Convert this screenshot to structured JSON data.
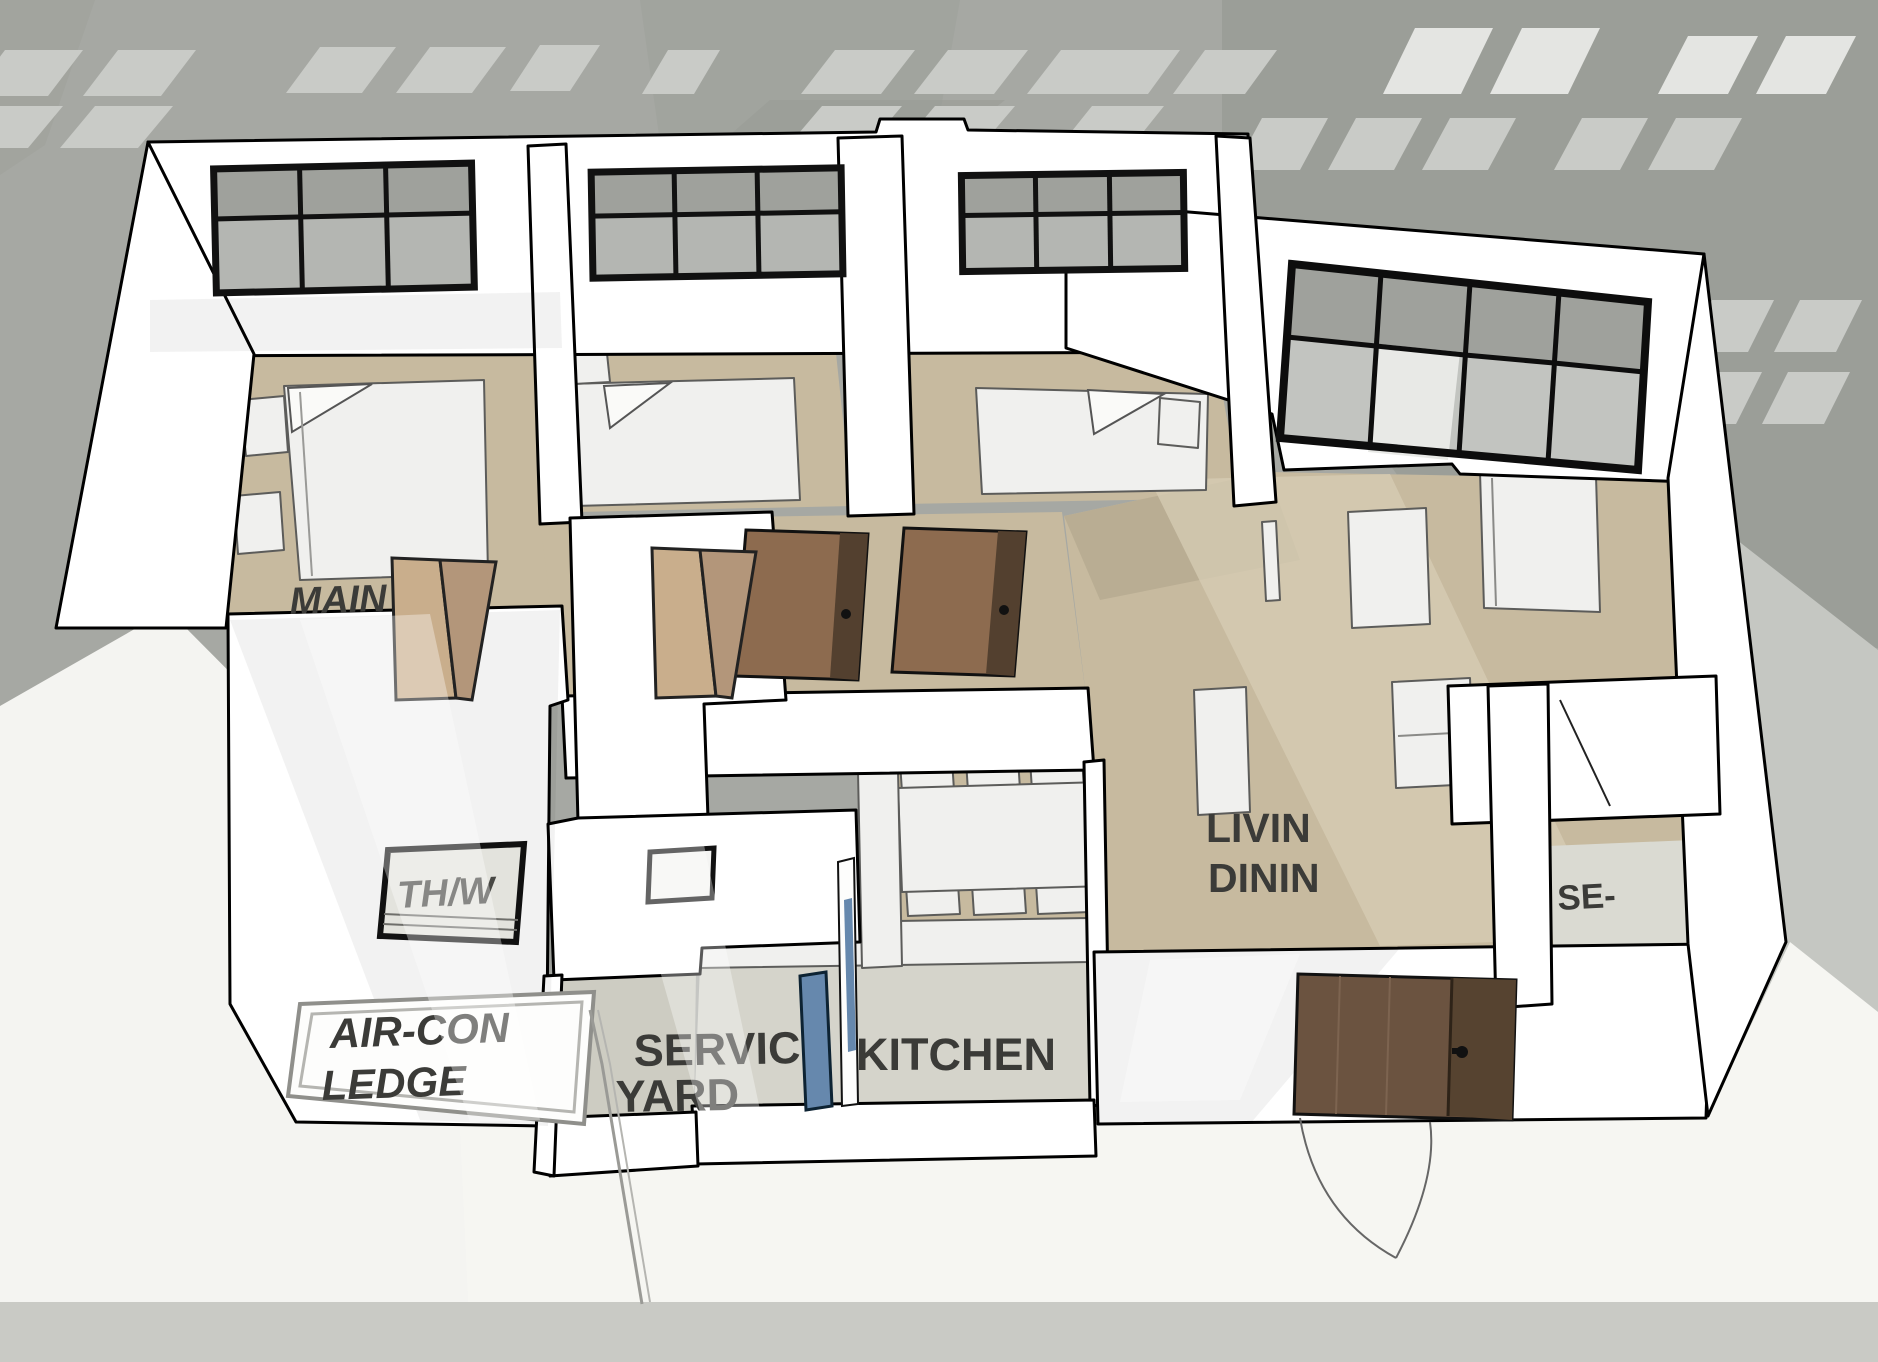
{
  "meta": {
    "scene_type": "3D floor plan cutaway render, SketchUp style",
    "view": "axonometric view of an apartment unit seen from above the front"
  },
  "colors": {
    "background_gray": "#a6a8a3",
    "building_silhouette": "#9b9e98",
    "background_window": "#c9cbc7",
    "background_window_bright": "#e4e5e2",
    "ground_white": "#f4f4f1",
    "ground_bottom_strip": "#c9cac5",
    "ground_right_gray": "#c5c7c2",
    "wall_white": "#ffffff",
    "wall_outline": "#000000",
    "floor_beige": "#c7ba9f",
    "floor_beige_dark": "#b9ad93",
    "floor_beige_light": "#d8ceb6",
    "floor_service_gray": "#d5d4cb",
    "window_frame_black": "#111111",
    "glass_gray": "#9fa19c",
    "door_wood_medium": "#8d6b4f",
    "door_wood_dark": "#5f4937",
    "door_wood_light": "#c9ae8c",
    "service_door_glass_blue": "#6688ad",
    "furniture_white": "#f0f0ee",
    "tv_panel_gray": "#72736e",
    "label_dark": "#3b3b38",
    "label_gray_seen_through_window": "#7c7c80"
  },
  "labels": {
    "main_bedroom": "MAIN",
    "bath_wc_partial": "TH/W",
    "aircon_ledge_line1": "AIR-CON",
    "aircon_ledge_line2": "LEDGE",
    "service_yard_line1": "SERVIC",
    "service_yard_line2": "YARD",
    "kitchen": "KITCHEN",
    "living_dining_line1": "LIVIN",
    "living_dining_line2": "DININ",
    "household_shelter_partial": "SE-"
  }
}
